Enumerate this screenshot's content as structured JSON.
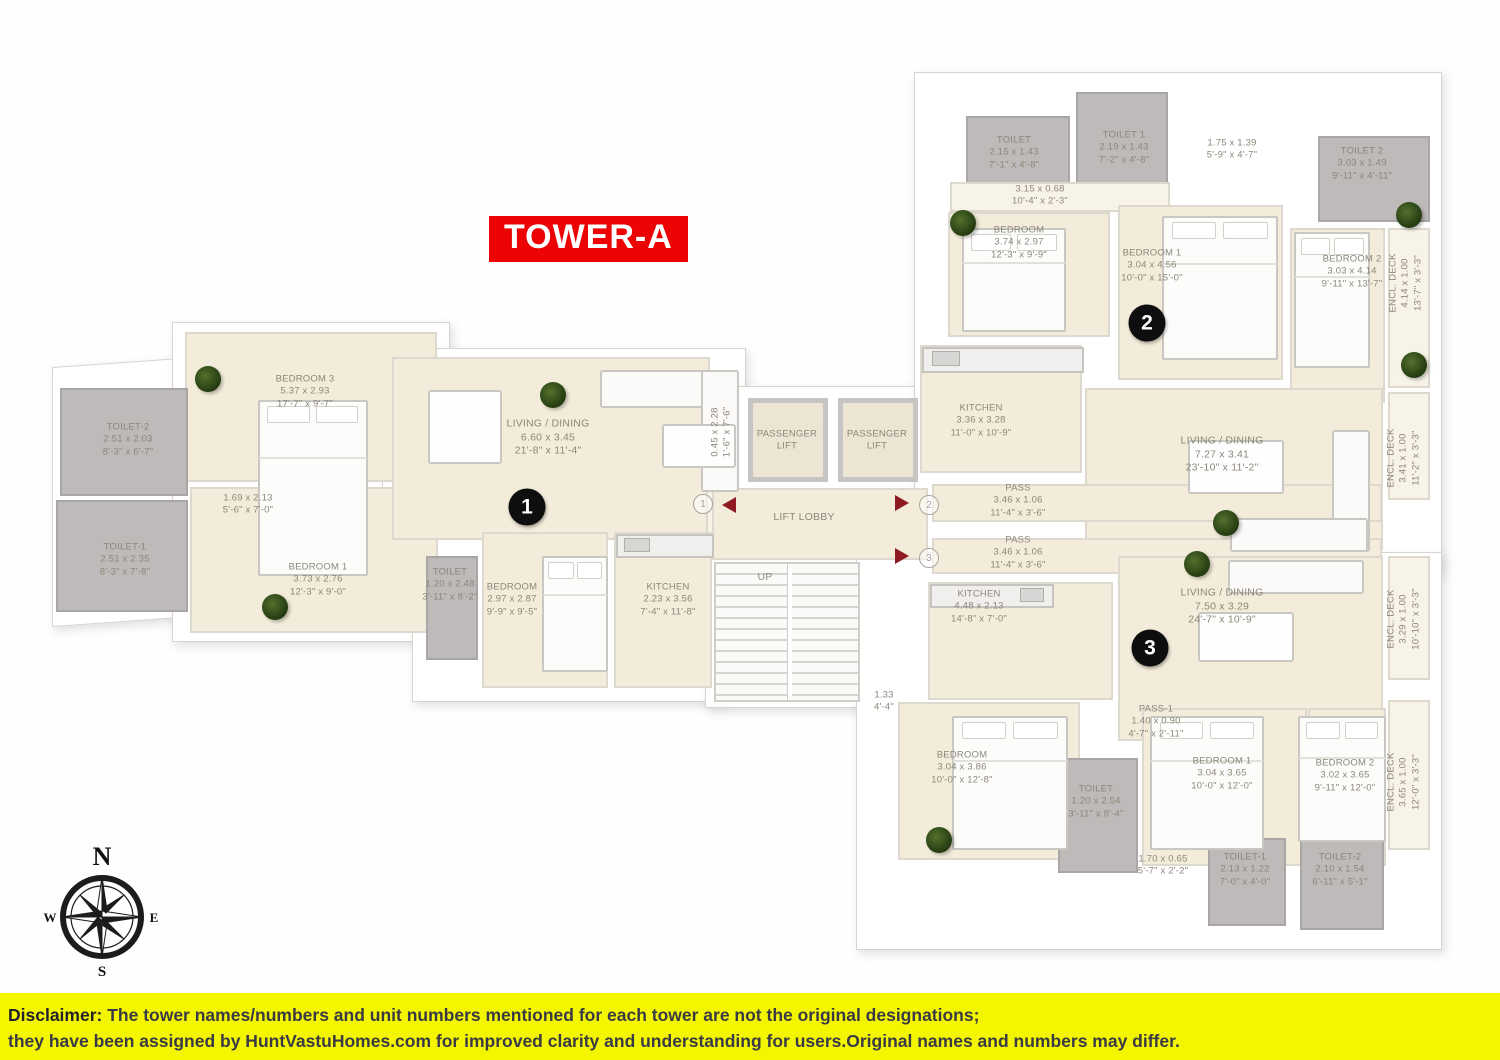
{
  "tower_badge": "TOWER-A",
  "compass": {
    "n": "N",
    "e": "E",
    "s": "S",
    "w": "W"
  },
  "disclaimer": {
    "label": "Disclaimer:",
    "line1": " The tower names/numbers and unit numbers mentioned for each tower are not the original designations;",
    "line2": "they have been assigned by HuntVastuHomes.com for improved clarity and understanding for users.Original names and numbers may differ."
  },
  "unit_markers": [
    "1",
    "2",
    "3"
  ],
  "door_markers": [
    "1",
    "2",
    "3"
  ],
  "rooms": {
    "u1": {
      "bedroom3": {
        "name": "BEDROOM 3",
        "m": "5.37 x 2.93",
        "ft": "17'-7\" x 9'-7\""
      },
      "toilet2": {
        "name": "TOILET-2",
        "m": "2.51 x 2.03",
        "ft": "8'-3\" x 6'-7\""
      },
      "toilet1": {
        "name": "TOILET-1",
        "m": "2.51 x 2.35",
        "ft": "8'-3\" x 7'-8\""
      },
      "pass": {
        "m": "1.69 x 2.13",
        "ft": "5'-6\" x 7'-0\""
      },
      "bedroom1": {
        "name": "BEDROOM 1",
        "m": "3.73 x 2.76",
        "ft": "12'-3\" x 9'-0\""
      },
      "living": {
        "name": "LIVING / DINING",
        "m": "6.60 x 3.45",
        "ft": "21'-8\" x 11'-4\""
      },
      "deck": {
        "m": "0.45 x 2.28",
        "ft": "1'-6\" x 7'-6\""
      },
      "toilet": {
        "name": "TOILET",
        "m": "1.20 x 2.48",
        "ft": "3'-11\" x 8'-2\""
      },
      "bedroom": {
        "name": "BEDROOM",
        "m": "2.97 x 2.87",
        "ft": "9'-9\" x 9'-5\""
      },
      "kitchen": {
        "name": "KITCHEN",
        "m": "2.23 x 3.56",
        "ft": "7'-4\" x 11'-8\""
      }
    },
    "core": {
      "lift_a": {
        "name": "PASSENGER\nLIFT"
      },
      "lift_b": {
        "name": "PASSENGER\nLIFT"
      },
      "lobby": {
        "name": "LIFT LOBBY"
      },
      "up": {
        "name": "UP"
      },
      "stair_pass": {
        "m": "1.33",
        "ft": "4'-4\""
      }
    },
    "u2": {
      "toilet": {
        "name": "TOILET",
        "m": "2.15 x 1.43",
        "ft": "7'-1\" x 4'-8\""
      },
      "toilet1": {
        "name": "TOILET 1",
        "m": "2.19 x 1.43",
        "ft": "7'-2\" x 4'-8\""
      },
      "pass_top": {
        "m": "3.15 x 0.68",
        "ft": "10'-4\" x 2'-3\""
      },
      "entry": {
        "m": "1.75 x 1.39",
        "ft": "5'-9\" x 4'-7\""
      },
      "toilet2": {
        "name": "TOILET 2",
        "m": "3.03 x 1.49",
        "ft": "9'-11\" x 4'-11\""
      },
      "bedroom": {
        "name": "BEDROOM",
        "m": "3.74 x 2.97",
        "ft": "12'-3\" x 9'-9\""
      },
      "bedroom1": {
        "name": "BEDROOM 1",
        "m": "3.04 x 4.56",
        "ft": "10'-0\" x 15'-0\""
      },
      "bedroom2": {
        "name": "BEDROOM 2",
        "m": "3.03 x 4.14",
        "ft": "9'-11\" x 13'-7\""
      },
      "deck_top": {
        "name": "ENCL. DECK",
        "m": "4.14 x 1.00",
        "ft": "13'-7\" x 3'-3\""
      },
      "kitchen": {
        "name": "KITCHEN",
        "m": "3.36 x 3.28",
        "ft": "11'-0\" x 10'-9\""
      },
      "living": {
        "name": "LIVING / DINING",
        "m": "7.27 x 3.41",
        "ft": "23'-10\" x 11'-2\""
      },
      "deck_mid": {
        "name": "ENCL. DECK",
        "m": "3.41 x 1.00",
        "ft": "11'-2\" x 3'-3\""
      },
      "pass": {
        "name": "PASS",
        "m": "3.46 x 1.06",
        "ft": "11'-4\" x 3'-6\""
      }
    },
    "u3": {
      "pass": {
        "name": "PASS",
        "m": "3.46 x 1.06",
        "ft": "11'-4\" x 3'-6\""
      },
      "kitchen": {
        "name": "KITCHEN",
        "m": "4.48 x 2.13",
        "ft": "14'-8\" x 7'-0\""
      },
      "living": {
        "name": "LIVING / DINING",
        "m": "7.50 x 3.29",
        "ft": "24'-7\" x 10'-9\""
      },
      "deck_mid": {
        "name": "ENCL. DECK",
        "m": "3.29 x 1.00",
        "ft": "10'-10\" x 3'-3\""
      },
      "pass1": {
        "name": "PASS-1",
        "m": "1.40 x 0.90",
        "ft": "4'-7\" x 2'-11\""
      },
      "bedroom": {
        "name": "BEDROOM",
        "m": "3.04 x 3.86",
        "ft": "10'-0\" x 12'-8\""
      },
      "toilet": {
        "name": "TOILET",
        "m": "1.20 x 2.54",
        "ft": "3'-11\" x 8'-4\""
      },
      "bedroom1": {
        "name": "BEDROOM 1",
        "m": "3.04 x 3.65",
        "ft": "10'-0\" x 12'-0\""
      },
      "bedroom2": {
        "name": "BEDROOM 2",
        "m": "3.02 x 3.65",
        "ft": "9'-11\" x 12'-0\""
      },
      "deck_bot": {
        "name": "ENCL. DECK",
        "m": "3.65 x 1.00",
        "ft": "12'-0\" x 3'-3\""
      },
      "entry": {
        "m": "1.70 x 0.65",
        "ft": "5'-7\" x 2'-2\""
      },
      "toilet1": {
        "name": "TOILET-1",
        "m": "2.13 x 1.22",
        "ft": "7'-0\" x 4'-0\""
      },
      "toilet2": {
        "name": "TOILET-2",
        "m": "2.10 x 1.54",
        "ft": "6'-11\" x 5'-1\""
      }
    }
  }
}
